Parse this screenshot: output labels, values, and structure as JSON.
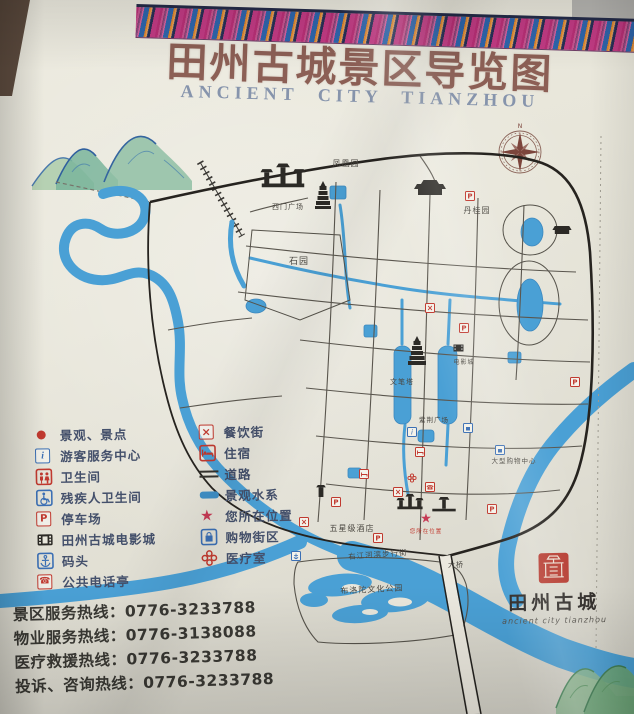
{
  "sign": {
    "title": "田州古城景区导览图",
    "subtitle": "ANCIENT CITY TIANZHOU"
  },
  "compass": {
    "north_label": "N"
  },
  "legend": {
    "columns": [
      {
        "items": [
          {
            "icon": "dot",
            "label": "景观、景点"
          },
          {
            "icon": "info",
            "label": "游客服务中心"
          },
          {
            "icon": "wc",
            "label": "卫生间"
          },
          {
            "icon": "wheelchair",
            "label": "残疾人卫生间"
          },
          {
            "icon": "parking",
            "label": "停车场"
          },
          {
            "icon": "cinema",
            "label": "田州古城电影城"
          },
          {
            "icon": "wharf",
            "label": "码头"
          },
          {
            "icon": "phone",
            "label": "公共电话亭"
          }
        ]
      },
      {
        "items": [
          {
            "icon": "dining",
            "label": "餐饮街"
          },
          {
            "icon": "lodging",
            "label": "住宿"
          },
          {
            "icon": "road",
            "label": "道路"
          },
          {
            "icon": "water",
            "label": "景观水系"
          },
          {
            "icon": "star",
            "label": "您所在位置"
          },
          {
            "icon": "shopping",
            "label": "购物街区"
          },
          {
            "icon": "medical",
            "label": "医疗室"
          }
        ]
      }
    ]
  },
  "hotlines": [
    {
      "label": "景区服务热线：",
      "number": "0776-3233788"
    },
    {
      "label": "物业服务热线：",
      "number": "0776-3138088"
    },
    {
      "label": "医疗救援热线：",
      "number": "0776-3233788"
    },
    {
      "label": "投诉、咨询热线：",
      "number": "0776-3233788"
    }
  ],
  "seal": {
    "name": "田州古城",
    "script": "ancient city tianzhou"
  },
  "map": {
    "labels": [
      {
        "text": "凤凰园",
        "x": 346,
        "y": 166,
        "size": 8
      },
      {
        "text": "西门广场",
        "x": 288,
        "y": 209,
        "size": 7
      },
      {
        "text": "丹桂园",
        "x": 477,
        "y": 213,
        "size": 8
      },
      {
        "text": "石园",
        "x": 299,
        "y": 264,
        "size": 9
      },
      {
        "text": "文笔塔",
        "x": 402,
        "y": 384,
        "size": 7
      },
      {
        "text": "电影城",
        "x": 464,
        "y": 364,
        "size": 6
      },
      {
        "text": "紫荆广场",
        "x": 434,
        "y": 422,
        "size": 6.5
      },
      {
        "text": "大型购物中心",
        "x": 514,
        "y": 463,
        "size": 6.5
      },
      {
        "text": "五星级酒店",
        "x": 352,
        "y": 531,
        "size": 8
      },
      {
        "text": "右江河滨步行街",
        "x": 378,
        "y": 557,
        "size": 7.5,
        "rotate": -4
      },
      {
        "text": "布洛陀文化公园",
        "x": 372,
        "y": 592,
        "size": 8,
        "rotate": -3
      },
      {
        "text": "大桥",
        "x": 456,
        "y": 567,
        "size": 7
      },
      {
        "text": "您所在位置",
        "x": 426,
        "y": 533,
        "size": 5.5,
        "color": "#c0392f"
      }
    ],
    "markers": [
      {
        "type": "parking",
        "x": 470,
        "y": 196
      },
      {
        "type": "parking",
        "x": 464,
        "y": 328
      },
      {
        "type": "parking",
        "x": 575,
        "y": 382
      },
      {
        "type": "parking",
        "x": 492,
        "y": 509
      },
      {
        "type": "parking",
        "x": 378,
        "y": 538
      },
      {
        "type": "parking",
        "x": 336,
        "y": 502
      },
      {
        "type": "dining",
        "x": 398,
        "y": 492
      },
      {
        "type": "dining",
        "x": 304,
        "y": 522
      },
      {
        "type": "dining",
        "x": 430,
        "y": 308
      },
      {
        "type": "lodging",
        "x": 420,
        "y": 452
      },
      {
        "type": "lodging",
        "x": 364,
        "y": 474
      },
      {
        "type": "shopping",
        "x": 500,
        "y": 450
      },
      {
        "type": "shopping",
        "x": 468,
        "y": 428
      },
      {
        "type": "medical",
        "x": 412,
        "y": 478
      },
      {
        "type": "phone",
        "x": 430,
        "y": 487
      },
      {
        "type": "info",
        "x": 412,
        "y": 432
      },
      {
        "type": "wharf",
        "x": 296,
        "y": 556
      },
      {
        "type": "cinema",
        "x": 458,
        "y": 348
      },
      {
        "type": "you-are-here",
        "x": 426,
        "y": 519
      }
    ]
  },
  "colors": {
    "title": "#8c5f55",
    "subtitle": "#8694ac",
    "river": "#4aa0d5",
    "legend_red": "#c0392f",
    "legend_blue": "#3b6fb4",
    "seal_red": "#b5392e"
  }
}
